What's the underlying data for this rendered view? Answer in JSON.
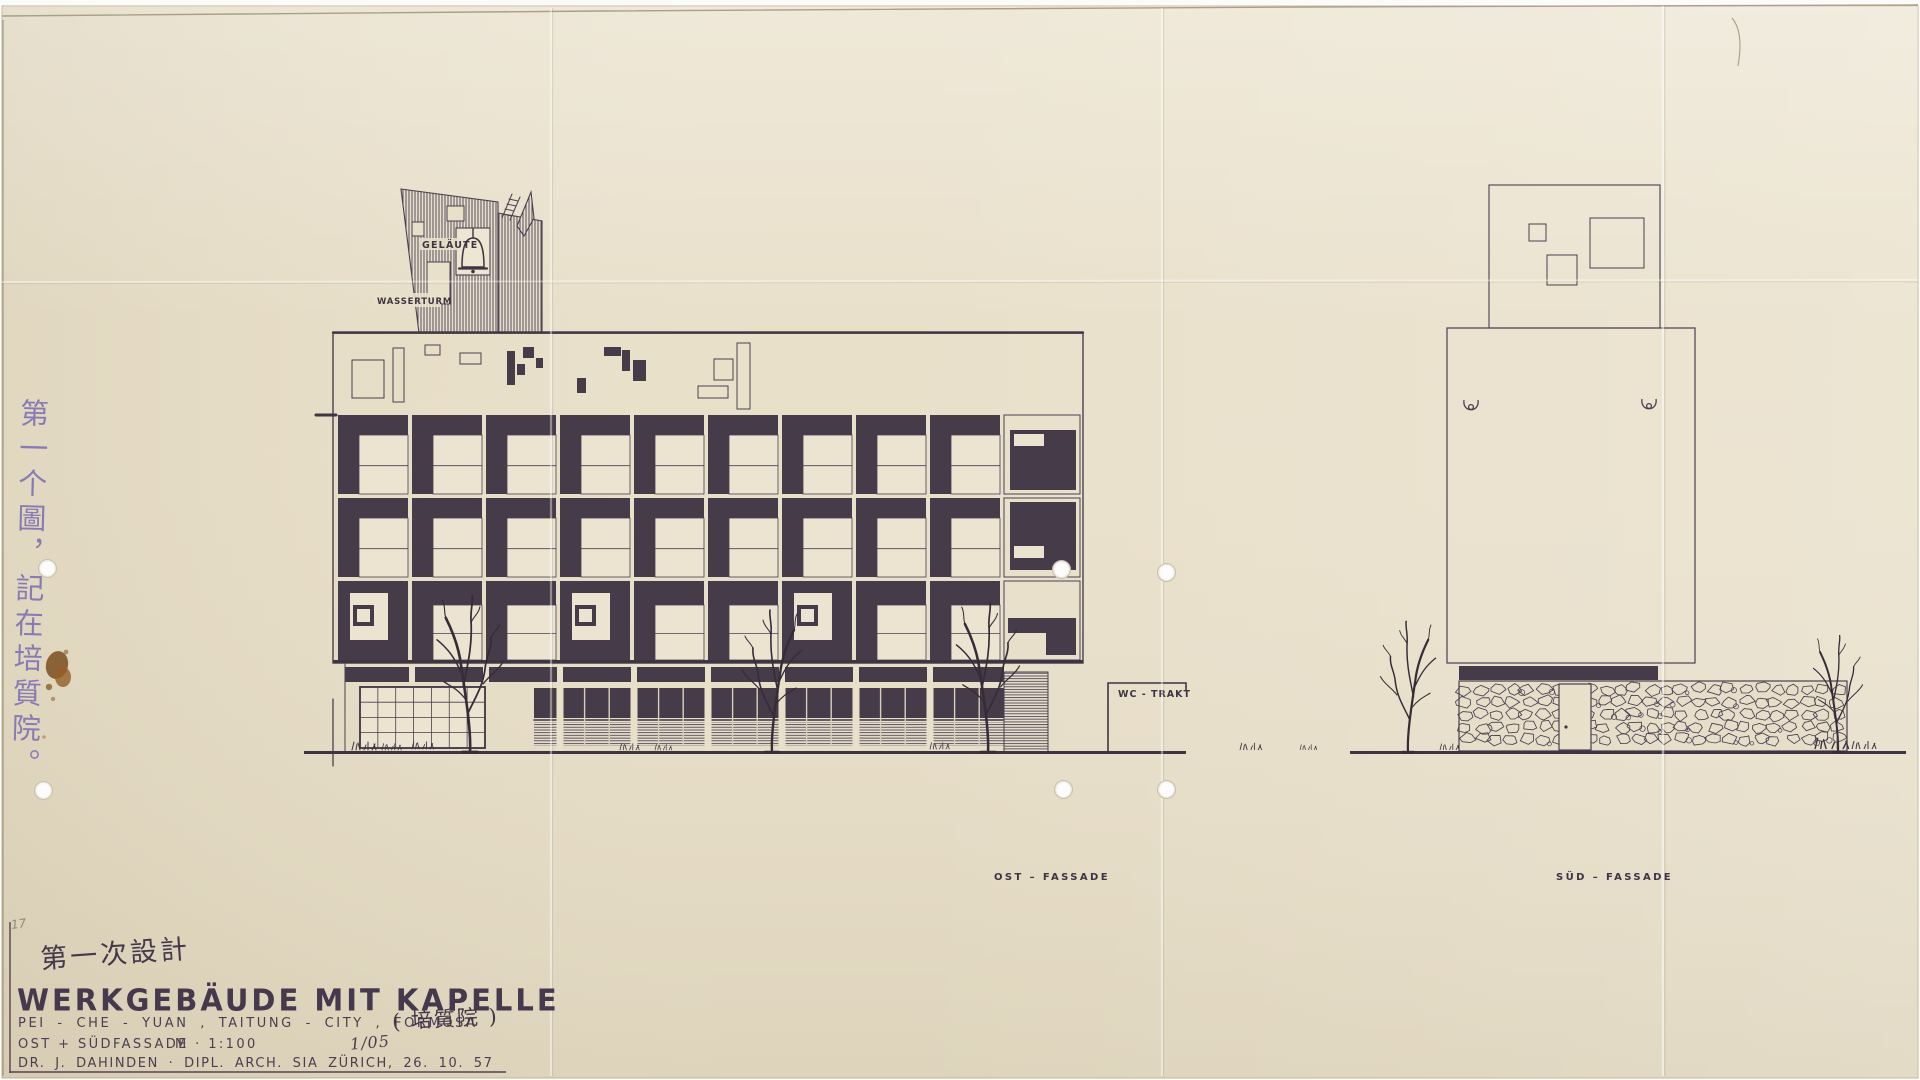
{
  "doc": {
    "labels": {
      "gelaeute": "GELÄUTE",
      "wasserturm": "WASSERTURM",
      "wc_trakt": "WC - TRAKT",
      "ost_fassade": "OST – FASSADE",
      "sued_fassade": "SÜD – FASSADE"
    },
    "annotations": {
      "corner_note": "17",
      "pencil_note_zh_vertical": "第一个圖，記在培質院。",
      "title_note_zh": "第一次設計",
      "location_zh": "( 培質院 )",
      "sheet_no": "1/05"
    },
    "title_block": {
      "title": "WERKGEBÄUDE  MIT  KAPELLE",
      "location": "PEI - CHE - YUAN ,  TAITUNG - CITY ,  FORMOSA",
      "drawing": "OST + SÜDFASSADE",
      "scale": "M · 1:100",
      "architect": "DR. J. DAHINDEN   ·   DIPL. ARCH. SIA   ZÜRICH,  26. 10. 57"
    },
    "colors": {
      "paper": "#e9e0ca",
      "ink": "#3e3442",
      "fill_dark": "#463b49",
      "handwriting_blue": "#8174b2",
      "stain_brown": "#7b4e20"
    }
  }
}
